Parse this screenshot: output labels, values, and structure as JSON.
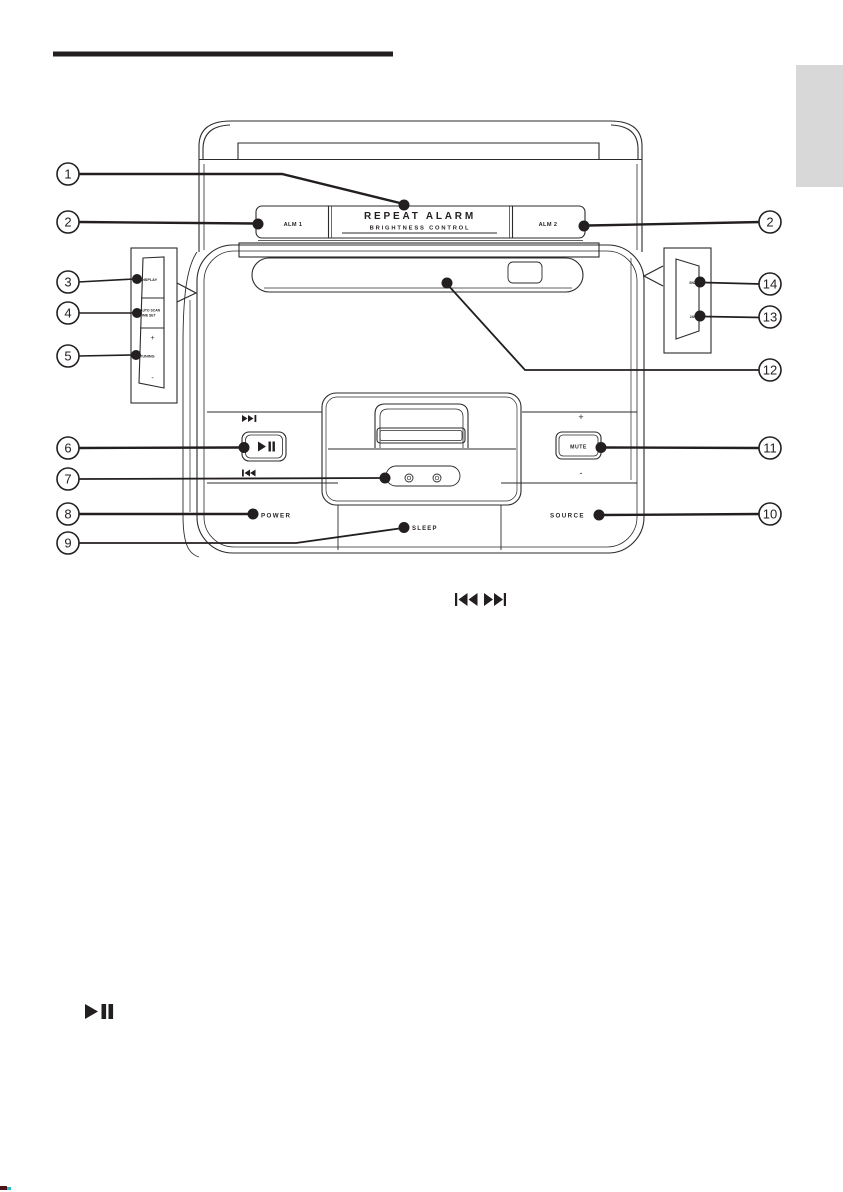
{
  "page": {
    "bg_color": "#ffffff",
    "ink_color": "#231f20",
    "language_tab_color": "#d8d8d8"
  },
  "figure": {
    "name": "main-unit-overview-diagram",
    "callout_numbers": [
      "1",
      "2",
      "3",
      "4",
      "5",
      "6",
      "7",
      "8",
      "9",
      "10",
      "11",
      "12",
      "13",
      "14"
    ],
    "top_bar": {
      "alm1": "ALM 1",
      "repeat_alarm": "REPEAT ALARM",
      "brightness_control": "BRIGHTNESS CONTROL",
      "alm2": "ALM 2"
    },
    "left_side_panel": {
      "display": "DISPLAY",
      "auto_scan": "AUTO SCAN",
      "time_set": "TIME SET",
      "plus": "+",
      "tuning": "TUNING",
      "minus": "-"
    },
    "right_side_panel": {
      "top": "SNZ",
      "bottom": "24H"
    },
    "front_controls": {
      "volume_plus": "+",
      "mute": "MUTE",
      "volume_minus": "-",
      "power": "POWER",
      "sleep": "SLEEP",
      "source": "SOURCE"
    }
  },
  "inline_icons": {
    "skip_icons": "previous-next-track",
    "play_pause_icon": "play-pause"
  }
}
